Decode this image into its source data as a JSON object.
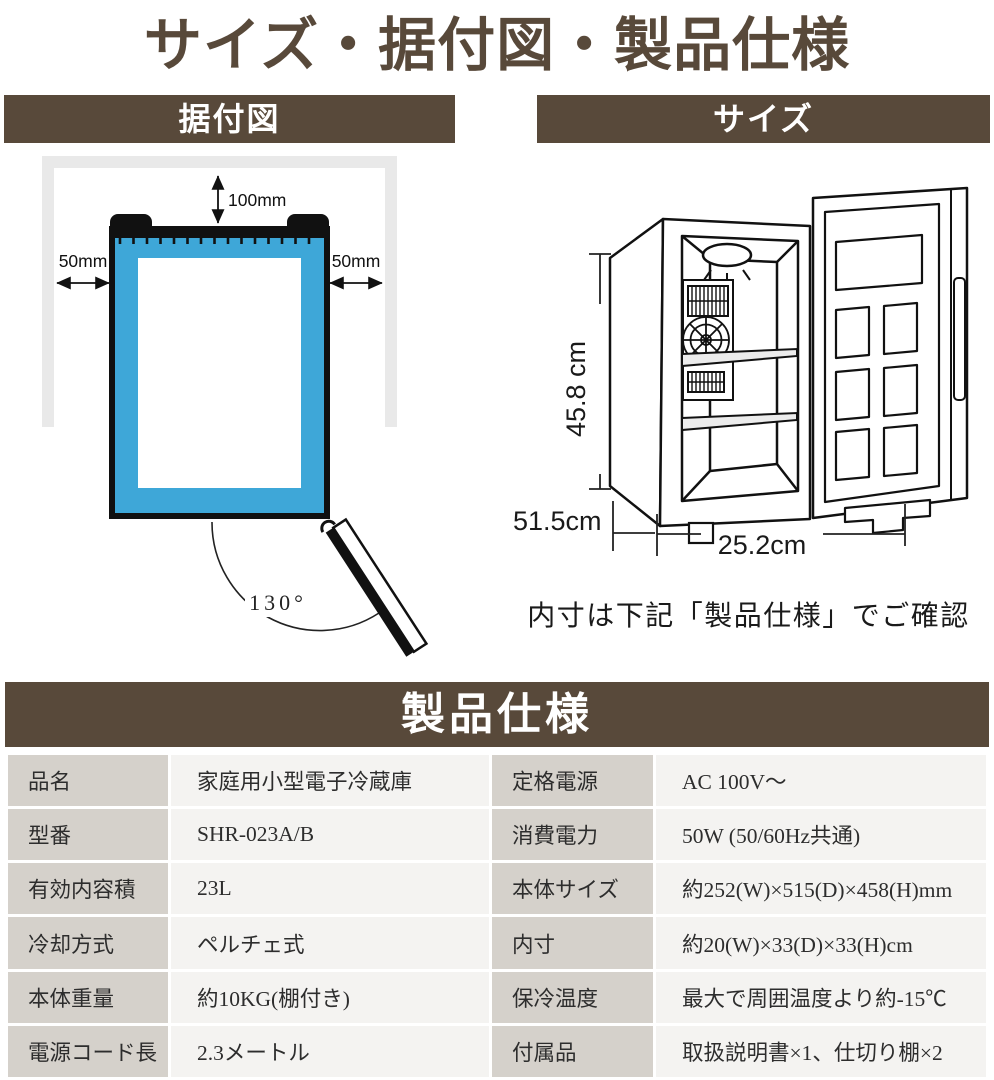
{
  "title": "サイズ・据付図・製品仕様",
  "install": {
    "header": "据付図",
    "top_clearance": "100mm",
    "left_clearance": "50mm",
    "right_clearance": "50mm",
    "door_angle": "130°"
  },
  "size": {
    "header": "サイズ",
    "height": "45.8 cm",
    "depth": "51.5cm",
    "width": "25.2cm",
    "note": "内寸は下記「製品仕様」でご確認"
  },
  "specs": {
    "header": "製品仕様",
    "left": [
      {
        "label": "品名",
        "value": "家庭用小型電子冷蔵庫"
      },
      {
        "label": "型番",
        "value": "SHR-023A/B"
      },
      {
        "label": "有効内容積",
        "value": "23L"
      },
      {
        "label": "冷却方式",
        "value": "ペルチェ式"
      },
      {
        "label": "本体重量",
        "value": "約10KG(棚付き)"
      },
      {
        "label": "電源コード長",
        "value": "2.3メートル"
      }
    ],
    "right": [
      {
        "label": "定格電源",
        "value": "AC 100V～"
      },
      {
        "label": "消費電力",
        "value": "50W (50/60Hz共通)"
      },
      {
        "label": "本体サイズ",
        "value": "約252(W)×515(D)×458(H)mm"
      },
      {
        "label": "内寸",
        "value": "約20(W)×33(D)×33(H)cm"
      },
      {
        "label": "保冷温度",
        "value": "最大で周囲温度より約-15℃"
      },
      {
        "label": "付属品",
        "value": "取扱説明書×1、仕切り棚×2"
      }
    ]
  },
  "colors": {
    "brown": "#58493A",
    "blue": "#3EA7D8",
    "wall_gray": "#E9E9E9",
    "label_bg": "#D5D1CB",
    "value_bg": "#F4F3F1"
  }
}
